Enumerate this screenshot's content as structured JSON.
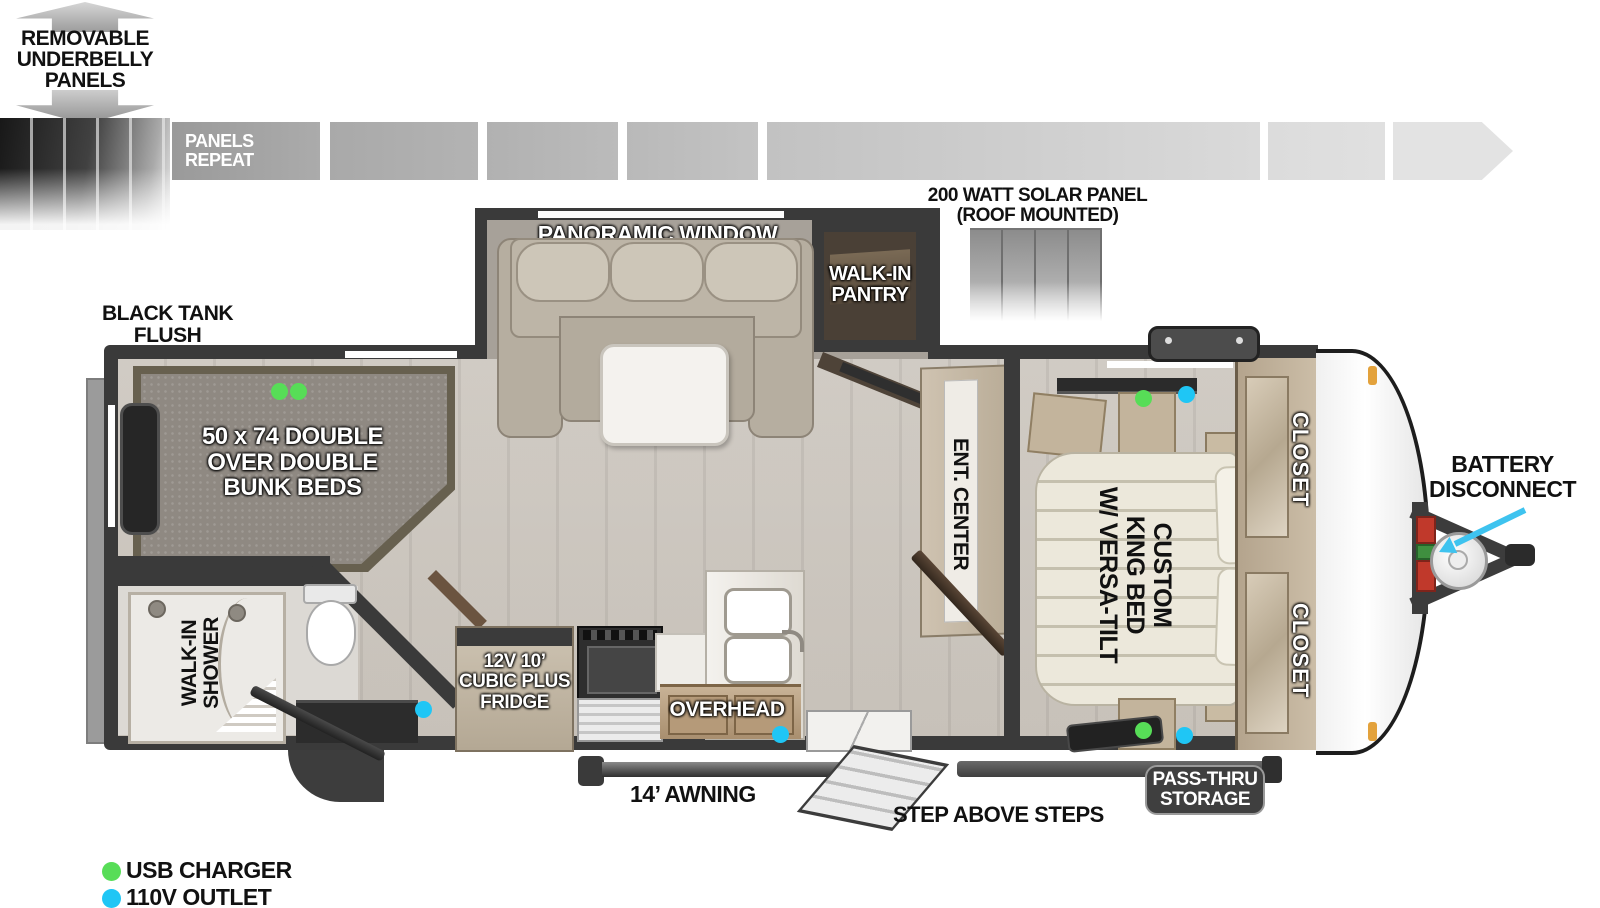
{
  "colors": {
    "usb_green": "#57dd57",
    "outlet_blue": "#1fc6f5",
    "arrow_cyan": "#3ec3ef",
    "wall_dark": "#3a3a3a",
    "floor_wood": "#d6d2cb"
  },
  "top": {
    "underbelly": [
      "REMOVABLE",
      "UNDERBELLY",
      "PANELS"
    ],
    "panels_repeat": [
      "PANELS",
      "REPEAT"
    ],
    "solar": [
      "200 WATT SOLAR PANEL",
      "(ROOF MOUNTED)"
    ]
  },
  "plan": {
    "black_tank": [
      "BLACK TANK",
      "FLUSH"
    ],
    "panoramic_window": "PANORAMIC WINDOW",
    "pantry": [
      "WALK-IN",
      "PANTRY"
    ],
    "bunks": [
      "50 x 74 DOUBLE",
      "OVER DOUBLE",
      "BUNK BEDS"
    ],
    "shower": [
      "WALK-IN",
      "SHOWER"
    ],
    "fridge": [
      "12V 10’",
      "CUBIC PLUS",
      "FRIDGE"
    ],
    "overhead": "OVERHEAD",
    "ent_center": "ENT. CENTER",
    "king_bed": [
      "CUSTOM",
      "KING BED",
      "W/ VERSA-TILT"
    ],
    "closet_top": "CLOSET",
    "closet_bottom": "CLOSET"
  },
  "exterior": {
    "battery": [
      "BATTERY",
      "DISCONNECT"
    ],
    "awning": "14’ AWNING",
    "steps": "STEP ABOVE STEPS",
    "pass_thru": [
      "PASS-THRU",
      "STORAGE"
    ]
  },
  "legend": {
    "usb": "USB CHARGER",
    "outlet": "110V OUTLET"
  }
}
